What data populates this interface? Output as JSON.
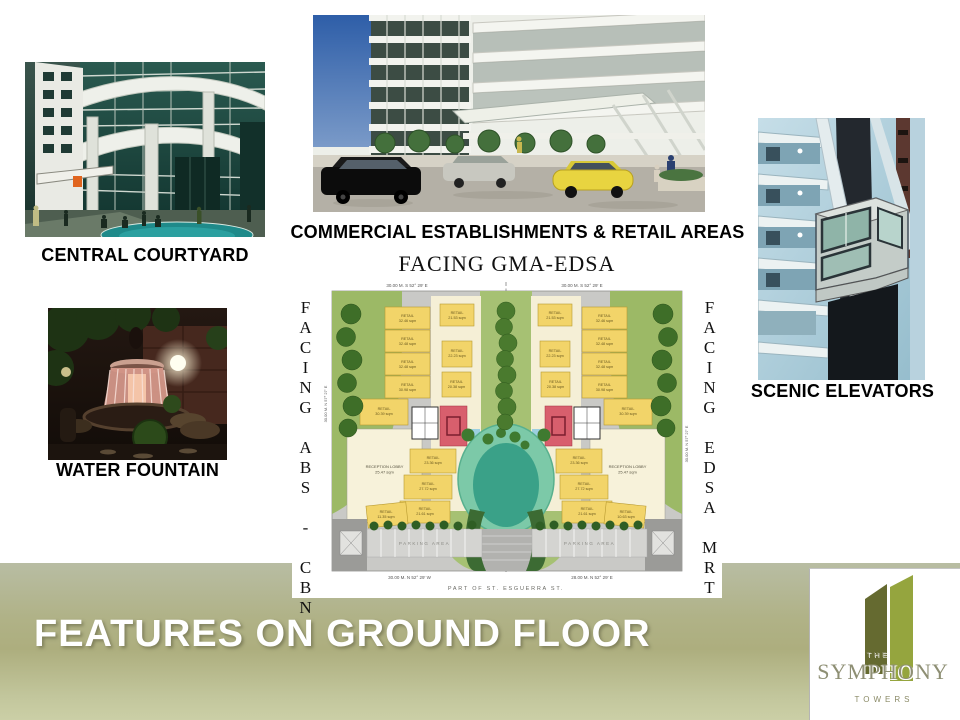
{
  "slide": {
    "title": "FEATURES ON GROUND FLOOR"
  },
  "photos": {
    "central_courtyard": {
      "label": "CENTRAL COURTYARD"
    },
    "commercial": {
      "label": "COMMERCIAL ESTABLISHMENTS & RETAIL AREAS"
    },
    "water_fountain": {
      "label": "WATER FOUNTAIN"
    },
    "scenic_elevators": {
      "label": "SCENIC ELEVATORS"
    }
  },
  "floor_plan": {
    "title": "FACING GMA-EDSA",
    "left_facing": "FACING ABS - CBN",
    "right_facing": "FACING EDSA MRT",
    "street": "PART OF ST. ESGUERRA ST.",
    "dim_top_left": "30.00 M. S 52° 29' E",
    "dim_top_right": "30.00 M. S 52° 29' E",
    "dim_bottom_left": "30.00 M. N 52° 29' W",
    "dim_bottom_right": "28.00 M. N 52° 29' E",
    "dim_side_left": "30.00 M. N 57° 27' E",
    "dim_side_right": "30.00 M. N 57° 27' E",
    "parking": "PARKING AREA",
    "reception_line1": "RECEPTION LOBBY",
    "reception_line2": "25.47 sqm",
    "retail": "RETAIL",
    "areas": {
      "a1": "32.46 sqm",
      "a2": "32.48 sqm",
      "a3": "32.48 sqm",
      "a4": "30.98 sqm",
      "a5": "30.39 sqm",
      "a6": "21.53 sqm",
      "a7": "22.23 sqm",
      "a8": "20.38 sqm",
      "a9": "23.36 sqm",
      "a10": "27.72 sqm",
      "a11": "21.61 sqm",
      "a12": "11.35 sqm",
      "a13": "10.63 sqm"
    }
  },
  "logo": {
    "the": "THE",
    "symphony": "SYMPHONY",
    "towers": "TOWERS"
  },
  "colors": {
    "banner_mid": "#adae7e",
    "plan_retail": "#f2d469",
    "plan_green": "#9cb966",
    "plan_pond": "#3aa188",
    "plan_red_core": "#d85f6d",
    "logo_tower_dark": "#656a30",
    "logo_tower_light": "#95a53e",
    "logo_text": "#8e8f74"
  }
}
